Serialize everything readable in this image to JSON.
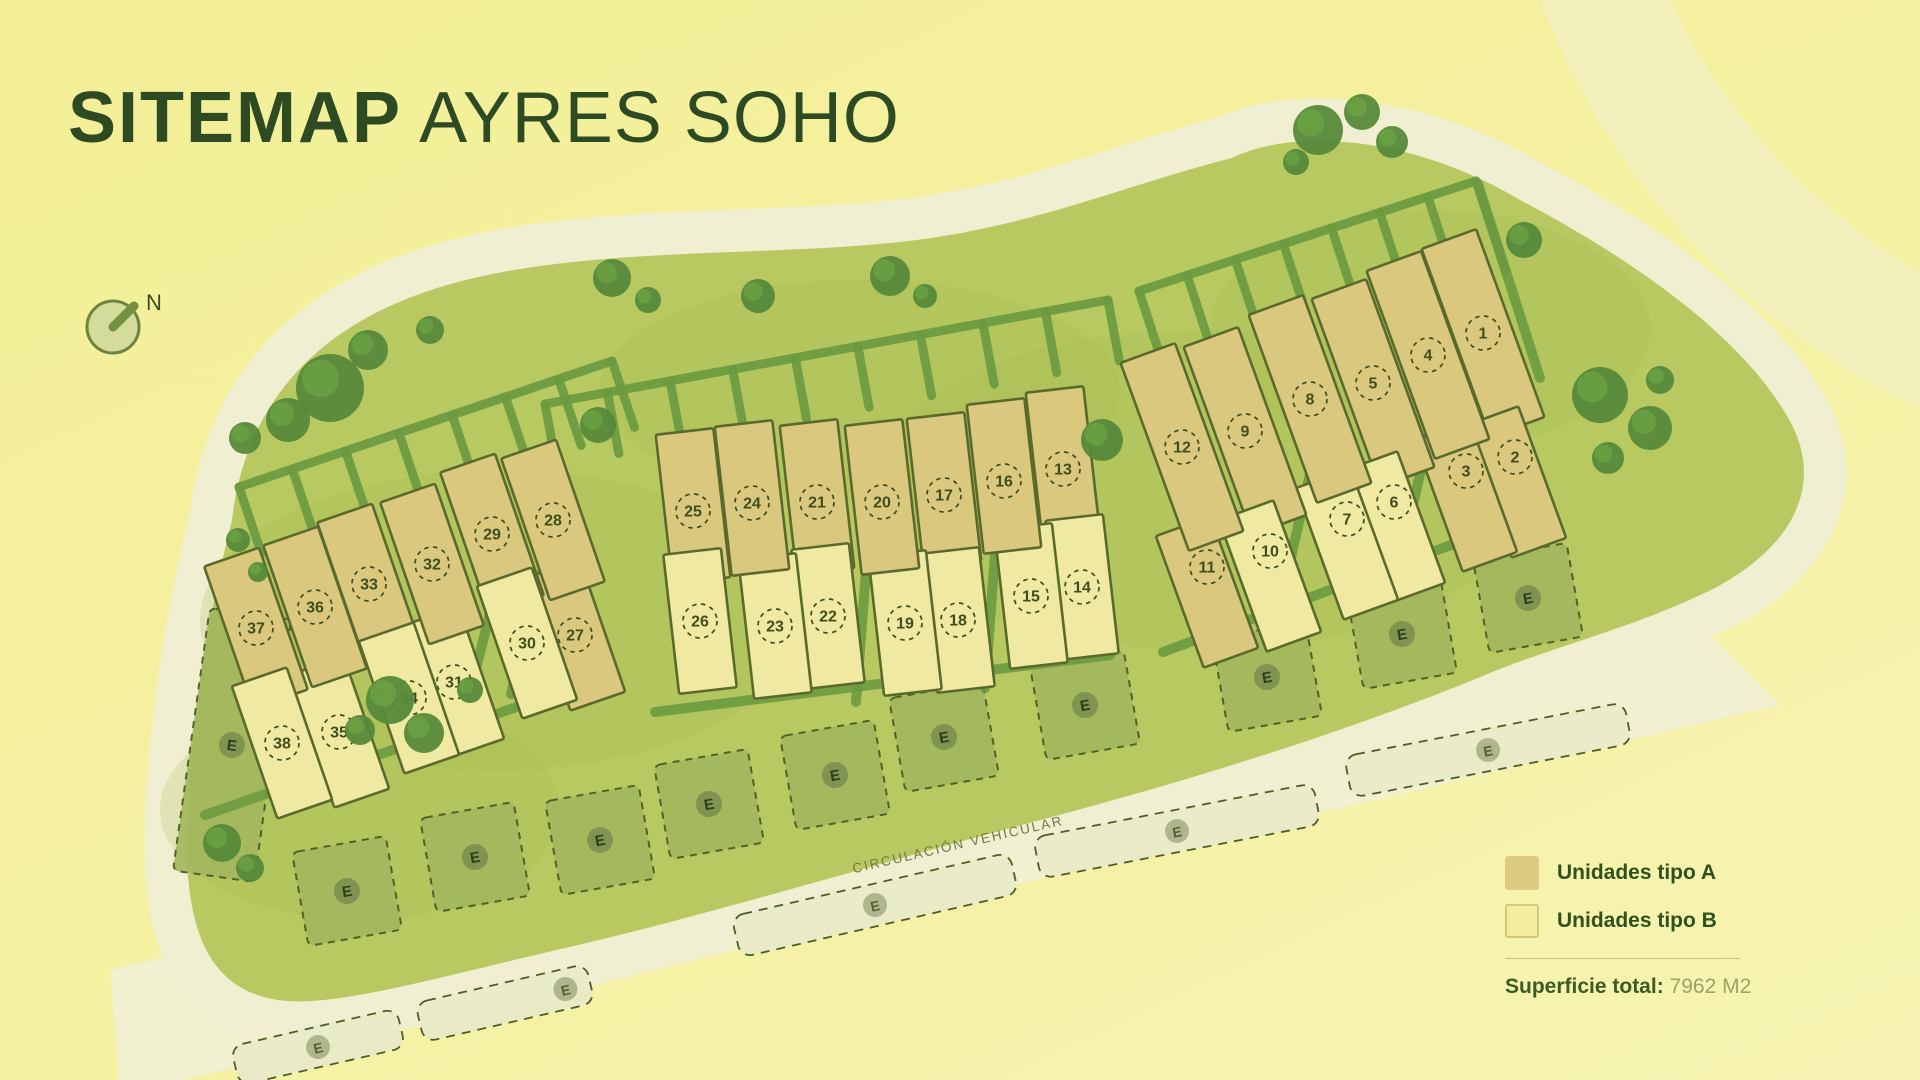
{
  "title": {
    "bold": "SITEMAP",
    "regular": " AYRES SOHO"
  },
  "compass": {
    "label": "N"
  },
  "road": {
    "label": "CIRCULACIÓN VEHICULAR"
  },
  "legend": {
    "items": [
      {
        "label": "Unidades tipo A",
        "color": "#ddcb81",
        "border": "#ddcb81"
      },
      {
        "label": "Unidades tipo B",
        "color": "#f2eda0",
        "border": "#d5c878"
      }
    ],
    "total_label": "Superficie total:",
    "total_value": "7962 M2"
  },
  "map": {
    "parking_label": "E",
    "lots": [
      {
        "n": 1,
        "type": "A",
        "row": "t",
        "cluster": "right",
        "x": 1483,
        "y": 333
      },
      {
        "n": 2,
        "type": "A",
        "row": "b",
        "cluster": "right",
        "x": 1515,
        "y": 457
      },
      {
        "n": 3,
        "type": "A",
        "row": "b",
        "cluster": "right",
        "x": 1466,
        "y": 471
      },
      {
        "n": 4,
        "type": "A",
        "row": "t",
        "cluster": "right",
        "x": 1428,
        "y": 355
      },
      {
        "n": 5,
        "type": "A",
        "row": "t",
        "cluster": "right",
        "x": 1373,
        "y": 383
      },
      {
        "n": 6,
        "type": "B",
        "row": "b",
        "cluster": "right",
        "x": 1394,
        "y": 502
      },
      {
        "n": 7,
        "type": "B",
        "row": "b",
        "cluster": "right",
        "x": 1347,
        "y": 519
      },
      {
        "n": 8,
        "type": "A",
        "row": "t",
        "cluster": "right",
        "x": 1310,
        "y": 399
      },
      {
        "n": 9,
        "type": "A",
        "row": "t",
        "cluster": "right",
        "x": 1245,
        "y": 431
      },
      {
        "n": 10,
        "type": "B",
        "row": "b",
        "cluster": "right",
        "x": 1270,
        "y": 551
      },
      {
        "n": 11,
        "type": "A",
        "row": "b",
        "cluster": "right",
        "x": 1207,
        "y": 567
      },
      {
        "n": 12,
        "type": "A",
        "row": "t",
        "cluster": "right",
        "x": 1182,
        "y": 447
      },
      {
        "n": 13,
        "type": "A",
        "row": "t",
        "cluster": "middle",
        "x": 1063,
        "y": 469
      },
      {
        "n": 14,
        "type": "B",
        "row": "b",
        "cluster": "middle",
        "x": 1082,
        "y": 587
      },
      {
        "n": 15,
        "type": "B",
        "row": "b",
        "cluster": "middle",
        "x": 1031,
        "y": 596
      },
      {
        "n": 16,
        "type": "A",
        "row": "t",
        "cluster": "middle",
        "x": 1004,
        "y": 481
      },
      {
        "n": 17,
        "type": "A",
        "row": "t",
        "cluster": "middle",
        "x": 944,
        "y": 495
      },
      {
        "n": 18,
        "type": "B",
        "row": "b",
        "cluster": "middle",
        "x": 958,
        "y": 620
      },
      {
        "n": 19,
        "type": "B",
        "row": "b",
        "cluster": "middle",
        "x": 905,
        "y": 623
      },
      {
        "n": 20,
        "type": "A",
        "row": "t",
        "cluster": "middle",
        "x": 882,
        "y": 502
      },
      {
        "n": 21,
        "type": "A",
        "row": "t",
        "cluster": "middle",
        "x": 817,
        "y": 502
      },
      {
        "n": 22,
        "type": "B",
        "row": "b",
        "cluster": "middle",
        "x": 828,
        "y": 616
      },
      {
        "n": 23,
        "type": "B",
        "row": "b",
        "cluster": "middle",
        "x": 775,
        "y": 626
      },
      {
        "n": 24,
        "type": "A",
        "row": "t",
        "cluster": "middle",
        "x": 752,
        "y": 503
      },
      {
        "n": 25,
        "type": "A",
        "row": "t",
        "cluster": "middle",
        "x": 693,
        "y": 511
      },
      {
        "n": 26,
        "type": "B",
        "row": "b",
        "cluster": "middle",
        "x": 700,
        "y": 621
      },
      {
        "n": 27,
        "type": "A",
        "row": "b",
        "cluster": "left",
        "x": 575,
        "y": 635
      },
      {
        "n": 28,
        "type": "A",
        "row": "t",
        "cluster": "left",
        "x": 553,
        "y": 520
      },
      {
        "n": 29,
        "type": "A",
        "row": "t",
        "cluster": "left",
        "x": 492,
        "y": 534
      },
      {
        "n": 30,
        "type": "B",
        "row": "b",
        "cluster": "left",
        "x": 527,
        "y": 643
      },
      {
        "n": 31,
        "type": "B",
        "row": "b",
        "cluster": "left",
        "x": 454,
        "y": 682
      },
      {
        "n": 32,
        "type": "A",
        "row": "t",
        "cluster": "left",
        "x": 432,
        "y": 564
      },
      {
        "n": 33,
        "type": "A",
        "row": "t",
        "cluster": "left",
        "x": 369,
        "y": 584
      },
      {
        "n": 34,
        "type": "B",
        "row": "b",
        "cluster": "left",
        "x": 409,
        "y": 698
      },
      {
        "n": 35,
        "type": "B",
        "row": "b",
        "cluster": "left",
        "x": 339,
        "y": 732
      },
      {
        "n": 36,
        "type": "A",
        "row": "t",
        "cluster": "left",
        "x": 315,
        "y": 607
      },
      {
        "n": 37,
        "type": "A",
        "row": "t",
        "cluster": "left",
        "x": 256,
        "y": 628
      },
      {
        "n": 38,
        "type": "B",
        "row": "b",
        "cluster": "left",
        "x": 282,
        "y": 743
      }
    ],
    "e_parcels": [
      {
        "x": 232,
        "y": 745,
        "w": 82,
        "h": 265,
        "rot": 8,
        "shape": "column"
      },
      {
        "x": 347,
        "y": 891,
        "w": 95,
        "h": 95,
        "rot": -10,
        "shape": "square"
      },
      {
        "x": 475,
        "y": 857,
        "w": 95,
        "h": 95,
        "rot": -10,
        "shape": "square"
      },
      {
        "x": 600,
        "y": 840,
        "w": 95,
        "h": 95,
        "rot": -10,
        "shape": "square"
      },
      {
        "x": 709,
        "y": 804,
        "w": 95,
        "h": 95,
        "rot": -10,
        "shape": "square"
      },
      {
        "x": 835,
        "y": 775,
        "w": 95,
        "h": 95,
        "rot": -10,
        "shape": "square"
      },
      {
        "x": 944,
        "y": 737,
        "w": 95,
        "h": 95,
        "rot": -10,
        "shape": "square"
      },
      {
        "x": 1085,
        "y": 705,
        "w": 95,
        "h": 95,
        "rot": -10,
        "shape": "square"
      },
      {
        "x": 1267,
        "y": 677,
        "w": 95,
        "h": 95,
        "rot": -10,
        "shape": "square"
      },
      {
        "x": 1402,
        "y": 634,
        "w": 95,
        "h": 95,
        "rot": -10,
        "shape": "square"
      },
      {
        "x": 1528,
        "y": 598,
        "w": 95,
        "h": 95,
        "rot": -10,
        "shape": "square"
      }
    ],
    "parking_strips": [
      {
        "x": 318,
        "y": 1047,
        "w": 170,
        "h": 40,
        "rot": -13,
        "badge_dx": 0
      },
      {
        "x": 505,
        "y": 1003,
        "w": 175,
        "h": 40,
        "rot": -13,
        "badge_dx": 62
      },
      {
        "x": 875,
        "y": 905,
        "w": 285,
        "h": 42,
        "rot": -13,
        "badge_dx": 0
      },
      {
        "x": 1177,
        "y": 831,
        "w": 285,
        "h": 42,
        "rot": -11,
        "badge_dx": 0
      },
      {
        "x": 1488,
        "y": 750,
        "w": 285,
        "h": 42,
        "rot": -11,
        "badge_dx": 0
      }
    ]
  },
  "colors": {
    "background": "#f4f09f",
    "site": "#b7c960",
    "site_shade": "#a4ba52",
    "road": "#f0efd2",
    "road_faint": "#f2f0c0",
    "lot_a": "#dac87e",
    "lot_b": "#f0e9a2",
    "lot_border": "#5a6a2d",
    "hedge": "#6b9a40",
    "tree": "#56893a",
    "tree_light": "#6ca344",
    "parking_fill": "#a3b75d",
    "strip_fill": "#e9ebc9",
    "dash": "#46571f",
    "badge_site": "#7b8c4e",
    "badge_strip": "#a9b086",
    "badge_letter": "#2e3c17",
    "number": "#3f4e1e",
    "road_label": "#6f7a45",
    "title": "#2e4a23",
    "compass_fill": "#d3dc9b",
    "compass_border": "#70833d",
    "compass_needle": "#72903f"
  }
}
